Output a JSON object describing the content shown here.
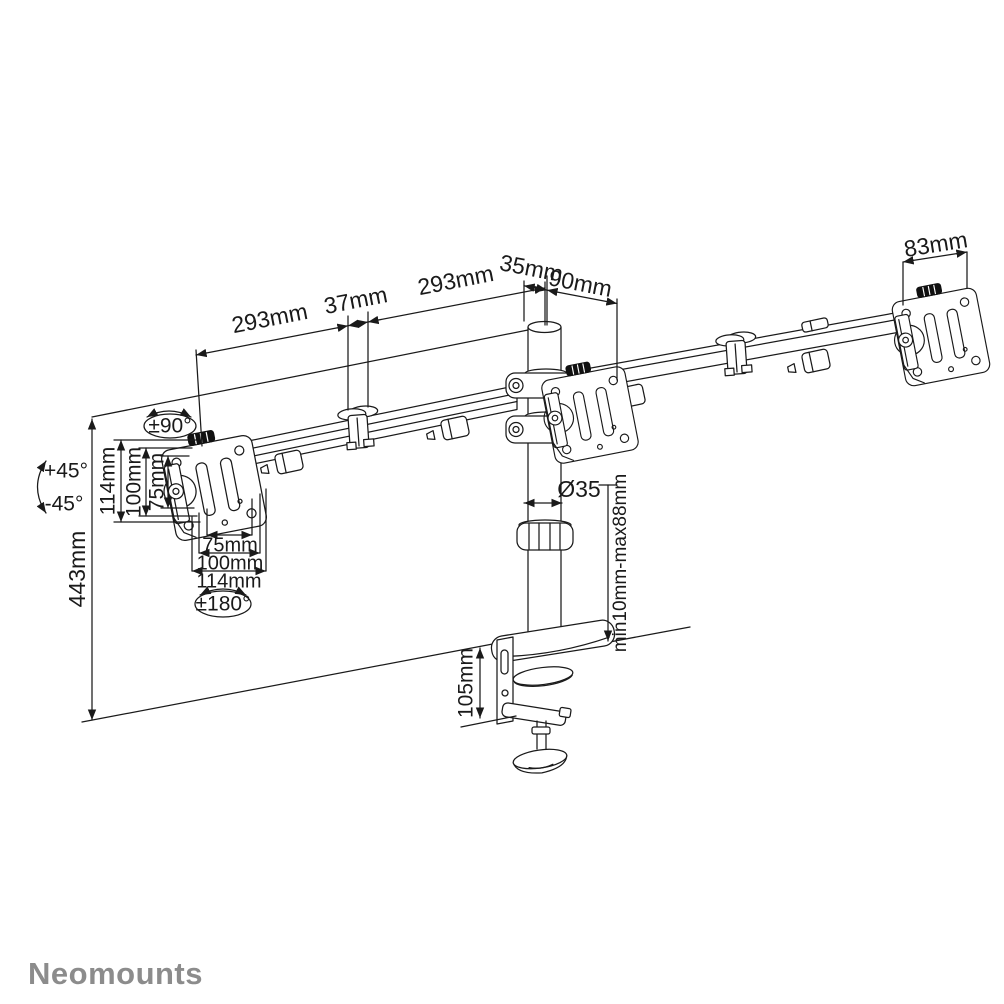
{
  "colors": {
    "background": "#ffffff",
    "line": "#1a1a1a",
    "thumbscrew": "#111111",
    "logo": "#8c8c8c"
  },
  "logo": {
    "text": "Neomounts"
  },
  "dimensions": {
    "arm_left_span": "293mm",
    "arm_joint_width": "37mm",
    "arm_right_span": "293mm",
    "pole_top_width": "35mm",
    "pole_to_plate_depth": "90mm",
    "vesa_plate_width": "83mm",
    "swivel_range": "±90°",
    "tilt_up": "+45°",
    "tilt_down": "-45°",
    "pole_height": "443mm",
    "vesa_vert_114": "114mm",
    "vesa_vert_100": "100mm",
    "vesa_vert_75": "75mm",
    "vesa_horiz_75": "75mm",
    "vesa_horiz_100": "100mm",
    "vesa_horiz_114": "114mm",
    "rotation_range": "±180°",
    "pole_diameter": "Ø35",
    "desk_thickness_range": "min10mm-max88mm",
    "clamp_height": "105mm"
  }
}
